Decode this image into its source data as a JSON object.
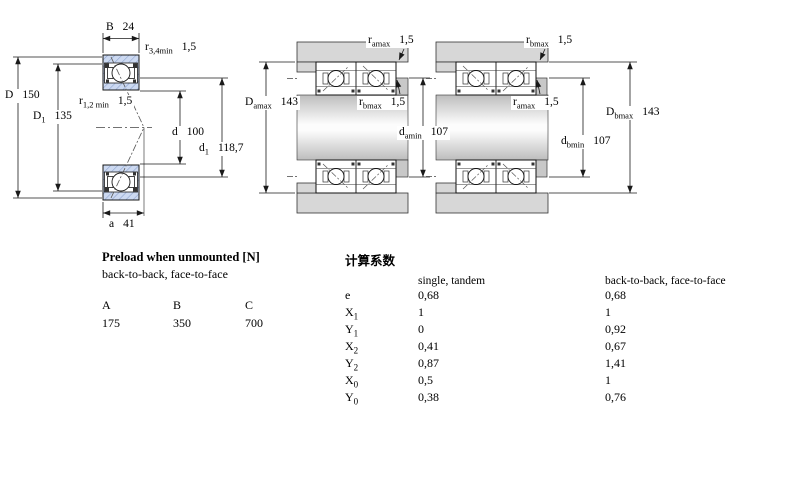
{
  "colors": {
    "bearing_fill": "#ccd9f1",
    "bearing_hatch": "#8aa0cc",
    "steel_gray": "#d7d7d7",
    "line": "#1a1a1a"
  },
  "left_view": {
    "dims": {
      "B": {
        "sym": "B",
        "sub": "",
        "val": "24"
      },
      "r34": {
        "sym": "r",
        "sub": "3,4min",
        "val": "1,5"
      },
      "D": {
        "sym": "D",
        "sub": "",
        "val": "150"
      },
      "D1": {
        "sym": "D",
        "sub": "1",
        "val": "135"
      },
      "r12": {
        "sym": "r",
        "sub": "1,2 min",
        "val": "1,5"
      },
      "d": {
        "sym": "d",
        "sub": "",
        "val": "100"
      },
      "d1": {
        "sym": "d",
        "sub": "1",
        "val": "118,7"
      },
      "a": {
        "sym": "a",
        "sub": "",
        "val": "41"
      }
    }
  },
  "mid_view": {
    "dims": {
      "r_amax_top": {
        "sym": "r",
        "sub": "amax",
        "val": "1,5"
      },
      "D_amax": {
        "sym": "D",
        "sub": "amax",
        "val": "143"
      },
      "r_bmax_mid": {
        "sym": "r",
        "sub": "bmax",
        "val": "1,5"
      },
      "d_amin": {
        "sym": "d",
        "sub": "amin",
        "val": "107"
      }
    }
  },
  "right_view": {
    "dims": {
      "r_bmax_top": {
        "sym": "r",
        "sub": "bmax",
        "val": "1,5"
      },
      "r_amax_mid": {
        "sym": "r",
        "sub": "amax",
        "val": "1,5"
      },
      "D_bmax": {
        "sym": "D",
        "sub": "bmax",
        "val": "143"
      },
      "d_bmin": {
        "sym": "d",
        "sub": "bmin",
        "val": "107"
      }
    }
  },
  "preload": {
    "title": "Preload when unmounted [N]",
    "subtitle": "back-to-back, face-to-face",
    "headers": [
      "A",
      "B",
      "C"
    ],
    "values": [
      "175",
      "350",
      "700"
    ]
  },
  "factors": {
    "title": "计算系数",
    "col1": "single, tandem",
    "col2": "back-to-back, face-to-face",
    "rows": [
      {
        "sym": "e",
        "sub": "",
        "v1": "0,68",
        "v2": "0,68"
      },
      {
        "sym": "X",
        "sub": "1",
        "v1": "1",
        "v2": "1"
      },
      {
        "sym": "Y",
        "sub": "1",
        "v1": "0",
        "v2": "0,92"
      },
      {
        "sym": "X",
        "sub": "2",
        "v1": "0,41",
        "v2": "0,67"
      },
      {
        "sym": "Y",
        "sub": "2",
        "v1": "0,87",
        "v2": "1,41"
      },
      {
        "sym": "X",
        "sub": "0",
        "v1": "0,5",
        "v2": "1"
      },
      {
        "sym": "Y",
        "sub": "0",
        "v1": "0,38",
        "v2": "0,76"
      }
    ]
  }
}
